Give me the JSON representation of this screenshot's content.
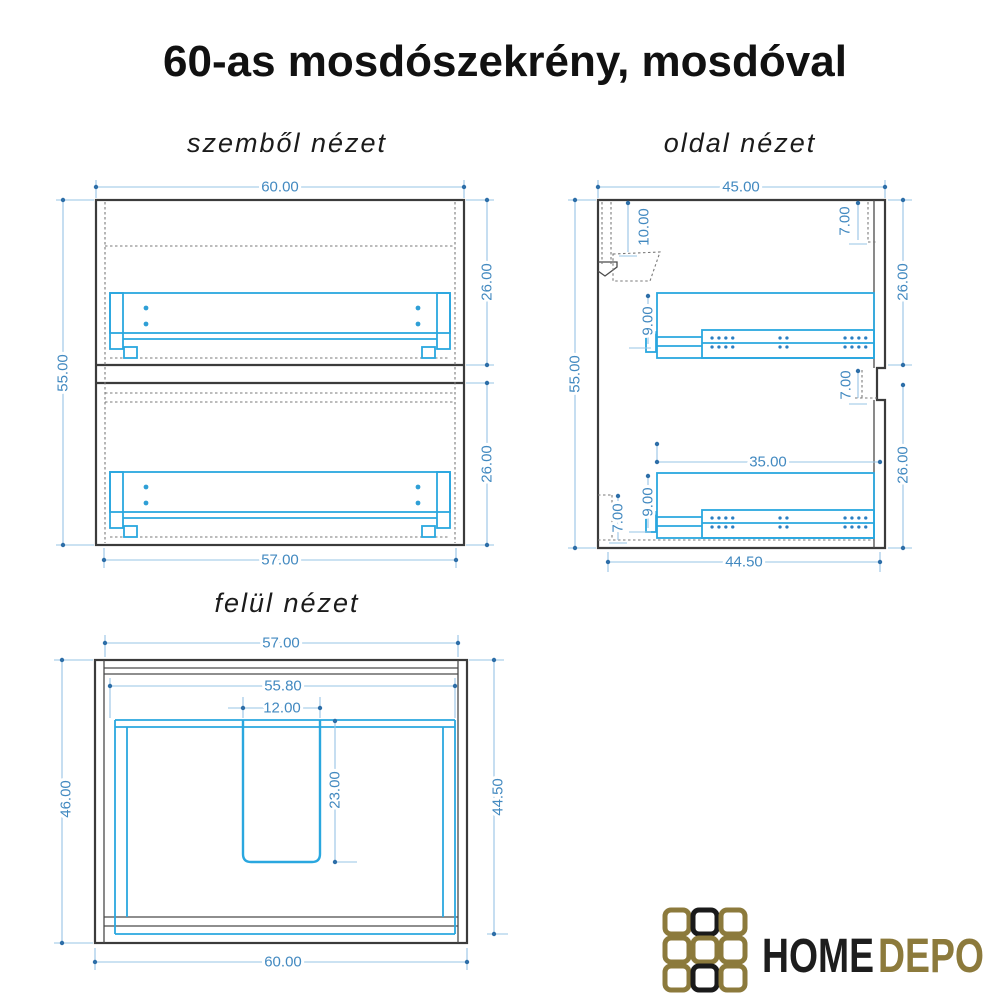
{
  "page": {
    "title": "60-as mosdószekrény, mosdóval"
  },
  "views": {
    "front": {
      "title": "szemből nézet",
      "dims": {
        "w60": "60.00",
        "h55": "55.00",
        "d26u": "26.00",
        "d26l": "26.00",
        "w57": "57.00"
      }
    },
    "side": {
      "title": "oldal nézet",
      "dims": {
        "w45": "45.00",
        "h55": "55.00",
        "d10": "10.00",
        "d7a": "7.00",
        "d26u": "26.00",
        "d9a": "9.00",
        "d7b": "7.00",
        "d35": "35.00",
        "d26l": "26.00",
        "d9b": "9.00",
        "d7c": "7.00",
        "w445": "44.50"
      }
    },
    "top": {
      "title": "felül nézet",
      "dims": {
        "w57": "57.00",
        "w558": "55.80",
        "w12": "12.00",
        "d23": "23.00",
        "h46": "46.00",
        "h445": "44.50",
        "w60": "60.00"
      }
    }
  },
  "logo": {
    "home": "HOME",
    "depo": "DEPO"
  },
  "colors": {
    "dimension_text": "#4289c0",
    "dimension_line": "#97c4e5",
    "drawing_cyan": "#2aa7df",
    "outline": "#3b3b3b",
    "logo_gold": "#8c7a3c",
    "logo_black": "#1a1a1a"
  }
}
